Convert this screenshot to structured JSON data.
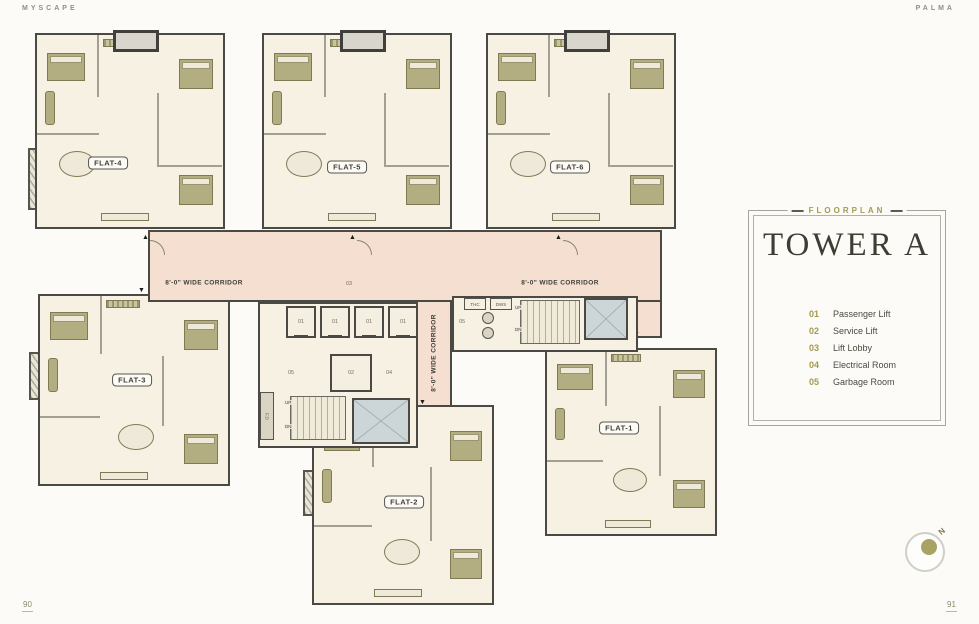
{
  "header": {
    "brand_left": "MYSCAPE",
    "brand_right": "PALMA"
  },
  "footer": {
    "page_left": "90",
    "page_right": "91"
  },
  "panel": {
    "eyebrow": "FLOORPLAN",
    "title": "TOWER A",
    "legend": [
      {
        "num": "01",
        "label": "Passenger Lift"
      },
      {
        "num": "02",
        "label": "Service Lift"
      },
      {
        "num": "03",
        "label": "Lift Lobby"
      },
      {
        "num": "04",
        "label": "Electrical Room"
      },
      {
        "num": "05",
        "label": "Garbage Room"
      }
    ]
  },
  "plan": {
    "flats": [
      {
        "label": "FLAT-1"
      },
      {
        "label": "FLAT-2"
      },
      {
        "label": "FLAT-3"
      },
      {
        "label": "FLAT-4"
      },
      {
        "label": "FLAT-5"
      },
      {
        "label": "FLAT-6"
      }
    ],
    "corridors": {
      "left": "8'-0\" WIDE CORRIDOR",
      "right": "8'-0\" WIDE CORRIDOR",
      "vertical": "8'-0\" WIDE CORRIDOR"
    },
    "core": {
      "passenger_lifts": [
        "01",
        "01",
        "01",
        "01"
      ],
      "service_lift": "02",
      "lift_lobby": "03",
      "electrical_room": "04",
      "garbage_left": "05",
      "garbage_right": "05",
      "thc": "THC",
      "dws": "DWS",
      "up_left": "UP",
      "dn_left": "DN",
      "up_right": "UP",
      "dn_right": "DN",
      "fire_duct": "F.D"
    },
    "compass": {
      "north": "N"
    }
  }
}
